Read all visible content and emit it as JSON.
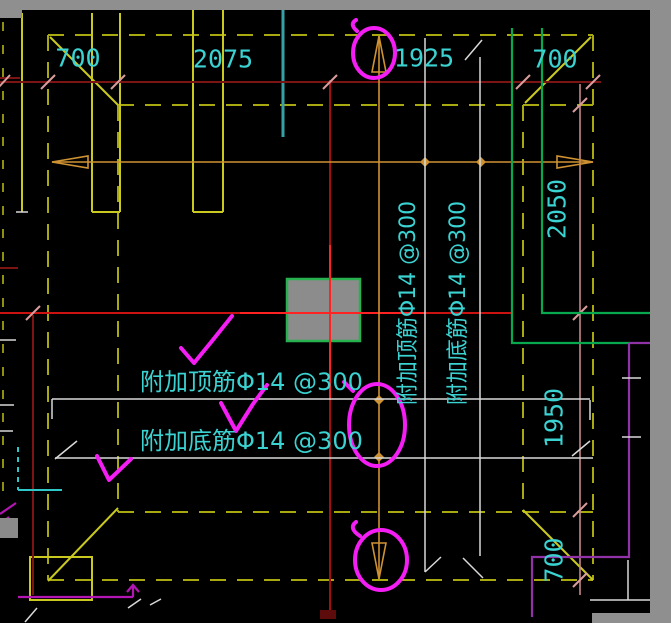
{
  "drawing": {
    "dim_top": [
      "700",
      "2075",
      "1925",
      "700"
    ],
    "dim_right": [
      "2050",
      "1950",
      "700"
    ],
    "notes": {
      "top_horizontal": "附加顶筋Φ14 @300",
      "bottom_horizontal": "附加底筋Φ14 @300",
      "top_vertical": "附加顶筋Φ14 @300",
      "bottom_vertical": "附加底筋Φ14 @300"
    },
    "colors": {
      "dimension_text": "#3bd2d2",
      "slab_lines": "#a8a810",
      "grid_red": "#cc1111",
      "column_fill": "#8c8c8c",
      "column_border": "#27b24f",
      "annotation_pink": "#f41ef4",
      "section_arrow_orange": "#cf9232",
      "wall_purple": "#9232a8",
      "rebar_white": "#d9d9d9"
    }
  }
}
